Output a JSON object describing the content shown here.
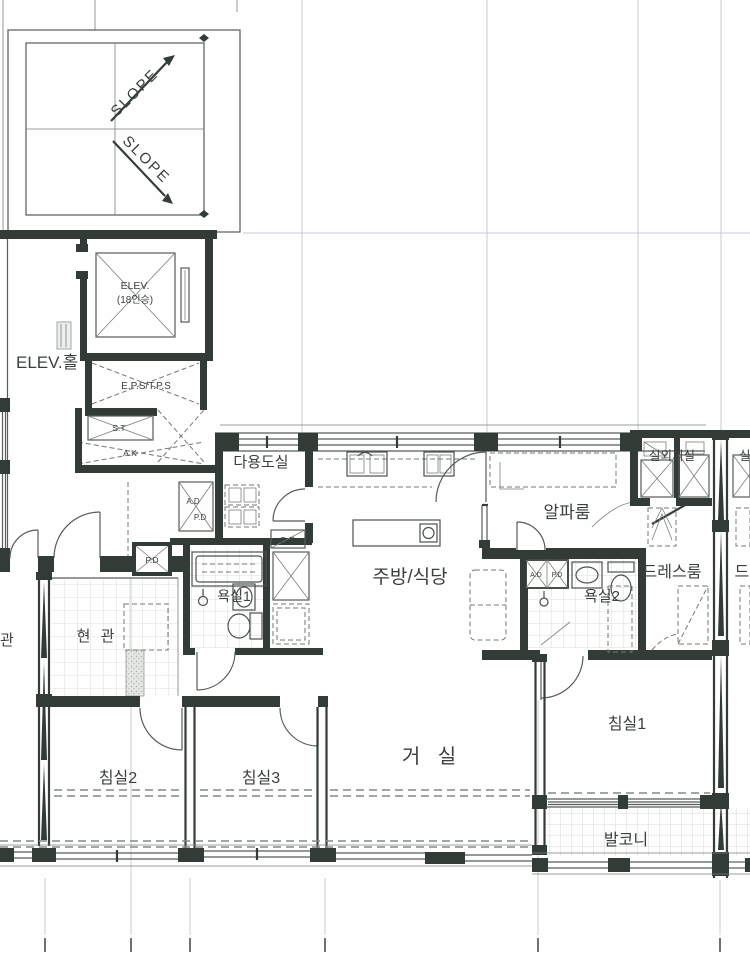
{
  "drawing": "apartment-floor-plan",
  "colors": {
    "wall": "#333b37",
    "line": "#565c59",
    "dashed": "#747974",
    "faint_grid": "#c6ccd6",
    "tile": "#d3d6d2",
    "text": "#3a403c",
    "paper": "#fefefe"
  },
  "labels": {
    "slope_upper": "SLOPE",
    "slope_lower": "SLOPE",
    "elev_hall": "ELEV.홀",
    "elevator": "ELEV.",
    "elevator_capacity": "(18인승)",
    "eps_tps": "E.P.S/T.P.S",
    "st": "S.T",
    "ak": "A.K",
    "utility_room": "다용도실",
    "shaft_ad": "A.D",
    "shaft_pd": "P.D",
    "pd_box": "P.D",
    "dr_box": "D.R",
    "bathroom1": "욕실1",
    "entrance": "현 관",
    "entrance_neighbor": "관",
    "kitchen_dining": "주방/식당",
    "alpha_room": "알파룸",
    "outdoor_unit_room": "실외기실",
    "outdoor_unit_room_mirror": "실외기실",
    "bathroom2": "욕실2",
    "bath2_ad": "A.D",
    "bath2_pd": "P.D",
    "dress_room": "드레스룸",
    "dress_room_mirror": "드레스룸",
    "living_room": "거 실",
    "bedroom1": "침실1",
    "bedroom2": "침실2",
    "bedroom3": "침실3",
    "balcony": "발코니"
  }
}
